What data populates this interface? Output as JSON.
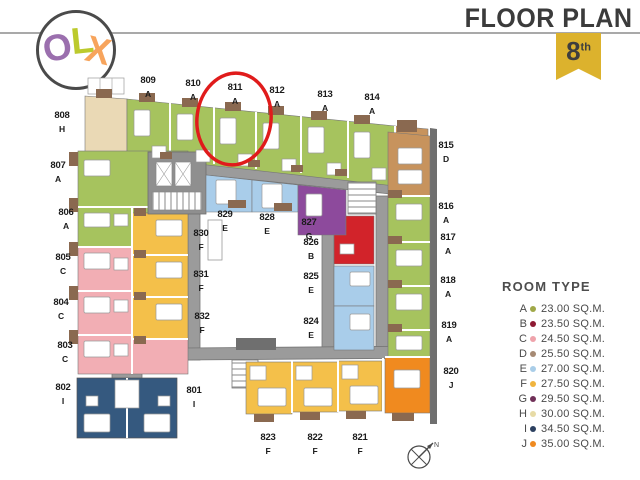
{
  "brand": {
    "name": "OLX",
    "letters": [
      {
        "char": "O",
        "color": "#9b6fae"
      },
      {
        "char": "L",
        "color": "#bcca2d"
      },
      {
        "char": "X",
        "color": "#f7a45c"
      }
    ]
  },
  "header": {
    "title": "FLOOR PLAN",
    "floor_number": "8",
    "floor_suffix": "th",
    "ribbon_color": "#dcb22d"
  },
  "legend": {
    "title": "ROOM TYPE",
    "items": [
      {
        "type": "A",
        "area": "23.00 SQ.M.",
        "dot_color": "#a0a848"
      },
      {
        "type": "B",
        "area": "23.50 SQ.M.",
        "dot_color": "#8e1a33"
      },
      {
        "type": "C",
        "area": "24.50 SQ.M.",
        "dot_color": "#efa3ab"
      },
      {
        "type": "D",
        "area": "25.50 SQ.M.",
        "dot_color": "#a68a74"
      },
      {
        "type": "E",
        "area": "27.00 SQ.M.",
        "dot_color": "#a9cde8"
      },
      {
        "type": "F",
        "area": "27.50 SQ.M.",
        "dot_color": "#f0b43f"
      },
      {
        "type": "G",
        "area": "29.50 SQ.M.",
        "dot_color": "#703058"
      },
      {
        "type": "H",
        "area": "30.00 SQ.M.",
        "dot_color": "#e7dba6"
      },
      {
        "type": "I",
        "area": "34.50 SQ.M.",
        "dot_color": "#2c4060"
      },
      {
        "type": "J",
        "area": "35.00 SQ.M.",
        "dot_color": "#ef8a20"
      }
    ]
  },
  "room_colors": {
    "A": "#a6c35e",
    "B": "#d2232a",
    "C": "#f2aeb4",
    "D": "#c7935d",
    "E": "#a9cdea",
    "F": "#f4c04a",
    "G": "#8d4a9c",
    "H": "#ead9b5",
    "I": "#35597f",
    "J": "#f08a1f"
  },
  "units": [
    {
      "number": "801",
      "type": "I"
    },
    {
      "number": "802",
      "type": "I"
    },
    {
      "number": "803",
      "type": "C"
    },
    {
      "number": "804",
      "type": "C"
    },
    {
      "number": "805",
      "type": "C"
    },
    {
      "number": "806",
      "type": "A"
    },
    {
      "number": "807",
      "type": "A"
    },
    {
      "number": "808",
      "type": "H"
    },
    {
      "number": "809",
      "type": "A"
    },
    {
      "number": "810",
      "type": "A"
    },
    {
      "number": "811",
      "type": "A"
    },
    {
      "number": "812",
      "type": "A"
    },
    {
      "number": "813",
      "type": "A"
    },
    {
      "number": "814",
      "type": "A"
    },
    {
      "number": "815",
      "type": "D"
    },
    {
      "number": "816",
      "type": "A"
    },
    {
      "number": "817",
      "type": "A"
    },
    {
      "number": "818",
      "type": "A"
    },
    {
      "number": "819",
      "type": "A"
    },
    {
      "number": "820",
      "type": "J"
    },
    {
      "number": "821",
      "type": "F"
    },
    {
      "number": "822",
      "type": "F"
    },
    {
      "number": "823",
      "type": "F"
    },
    {
      "number": "824",
      "type": "E"
    },
    {
      "number": "825",
      "type": "E"
    },
    {
      "number": "826",
      "type": "B"
    },
    {
      "number": "827",
      "type": "G"
    },
    {
      "number": "828",
      "type": "E"
    },
    {
      "number": "829",
      "type": "E"
    },
    {
      "number": "830",
      "type": "F"
    },
    {
      "number": "831",
      "type": "F"
    },
    {
      "number": "832",
      "type": "F"
    }
  ],
  "highlight": {
    "unit": "811",
    "color": "#e01b1b"
  },
  "compass": {
    "label": "N"
  }
}
